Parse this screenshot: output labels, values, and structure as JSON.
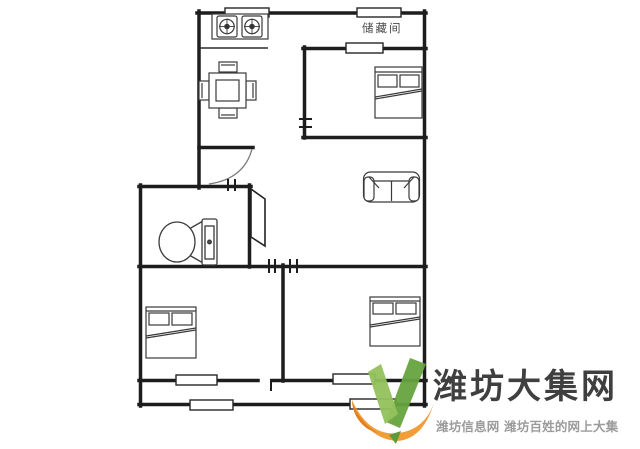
{
  "page": {
    "background": "#ffffff"
  },
  "floorplan": {
    "storage_label": "储藏间",
    "line_color": "#1d1d1d",
    "rooms": [
      "kitchen",
      "storage-room",
      "bedroom-top-right",
      "bathroom",
      "living-room",
      "bedroom-bottom-left",
      "bedroom-bottom-right",
      "balcony"
    ],
    "furniture": [
      "gas-stove",
      "dining-table",
      "toilet",
      "sofa",
      "double-bed",
      "double-bed",
      "double-bed"
    ],
    "window_count": 7
  },
  "watermark": {
    "title": "潍坊大集网",
    "subtitle": "潍坊信息网 潍坊百姓的网上大集",
    "colors": {
      "check_left": "#94c15c",
      "check_right": "#67a33e",
      "swoosh": "#f29d38",
      "swoosh_dark": "#e0801f",
      "leaf": "#5e9a3a",
      "title": "#3f3f3f",
      "subtitle": "#9b9b9b"
    }
  }
}
